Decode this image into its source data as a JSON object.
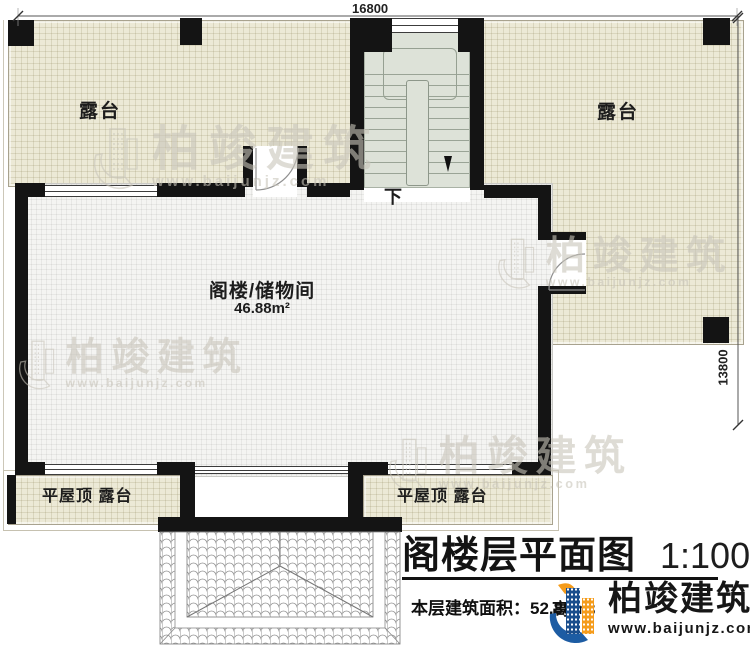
{
  "dimensions": {
    "width_top": "16800",
    "depth_right": "13800"
  },
  "labels": {
    "terrace_top_left": "露台",
    "terrace_top_right": "露台",
    "attic_name": "阁楼/储物间",
    "attic_area": "46.88m²",
    "stairs_down": "下",
    "flat_roof_terrace_left": "平屋顶 露台",
    "flat_roof_terrace_right": "平屋顶 露台"
  },
  "title_block": {
    "title": "阁楼层平面图",
    "scale": "1:100",
    "floor_area_line": "本层建筑面积：52.88m²",
    "occluded_text_fragment": "高　3"
  },
  "branding": {
    "company": "柏竣建筑",
    "website": "www.baijunjz.com"
  },
  "watermark": {
    "company": "柏竣建筑",
    "website": "www.baijunjz.com"
  },
  "colors": {
    "wall": "#141414",
    "terrace_fill": "#ece9d6",
    "room_fill": "#f4f4f2",
    "stair_fill": "#dde2d8",
    "logo_blue": "#1d5ca3",
    "logo_navy": "#1b4e8c",
    "logo_orange": "#f59c1c",
    "watermark_gray": "#c9c5ba"
  }
}
